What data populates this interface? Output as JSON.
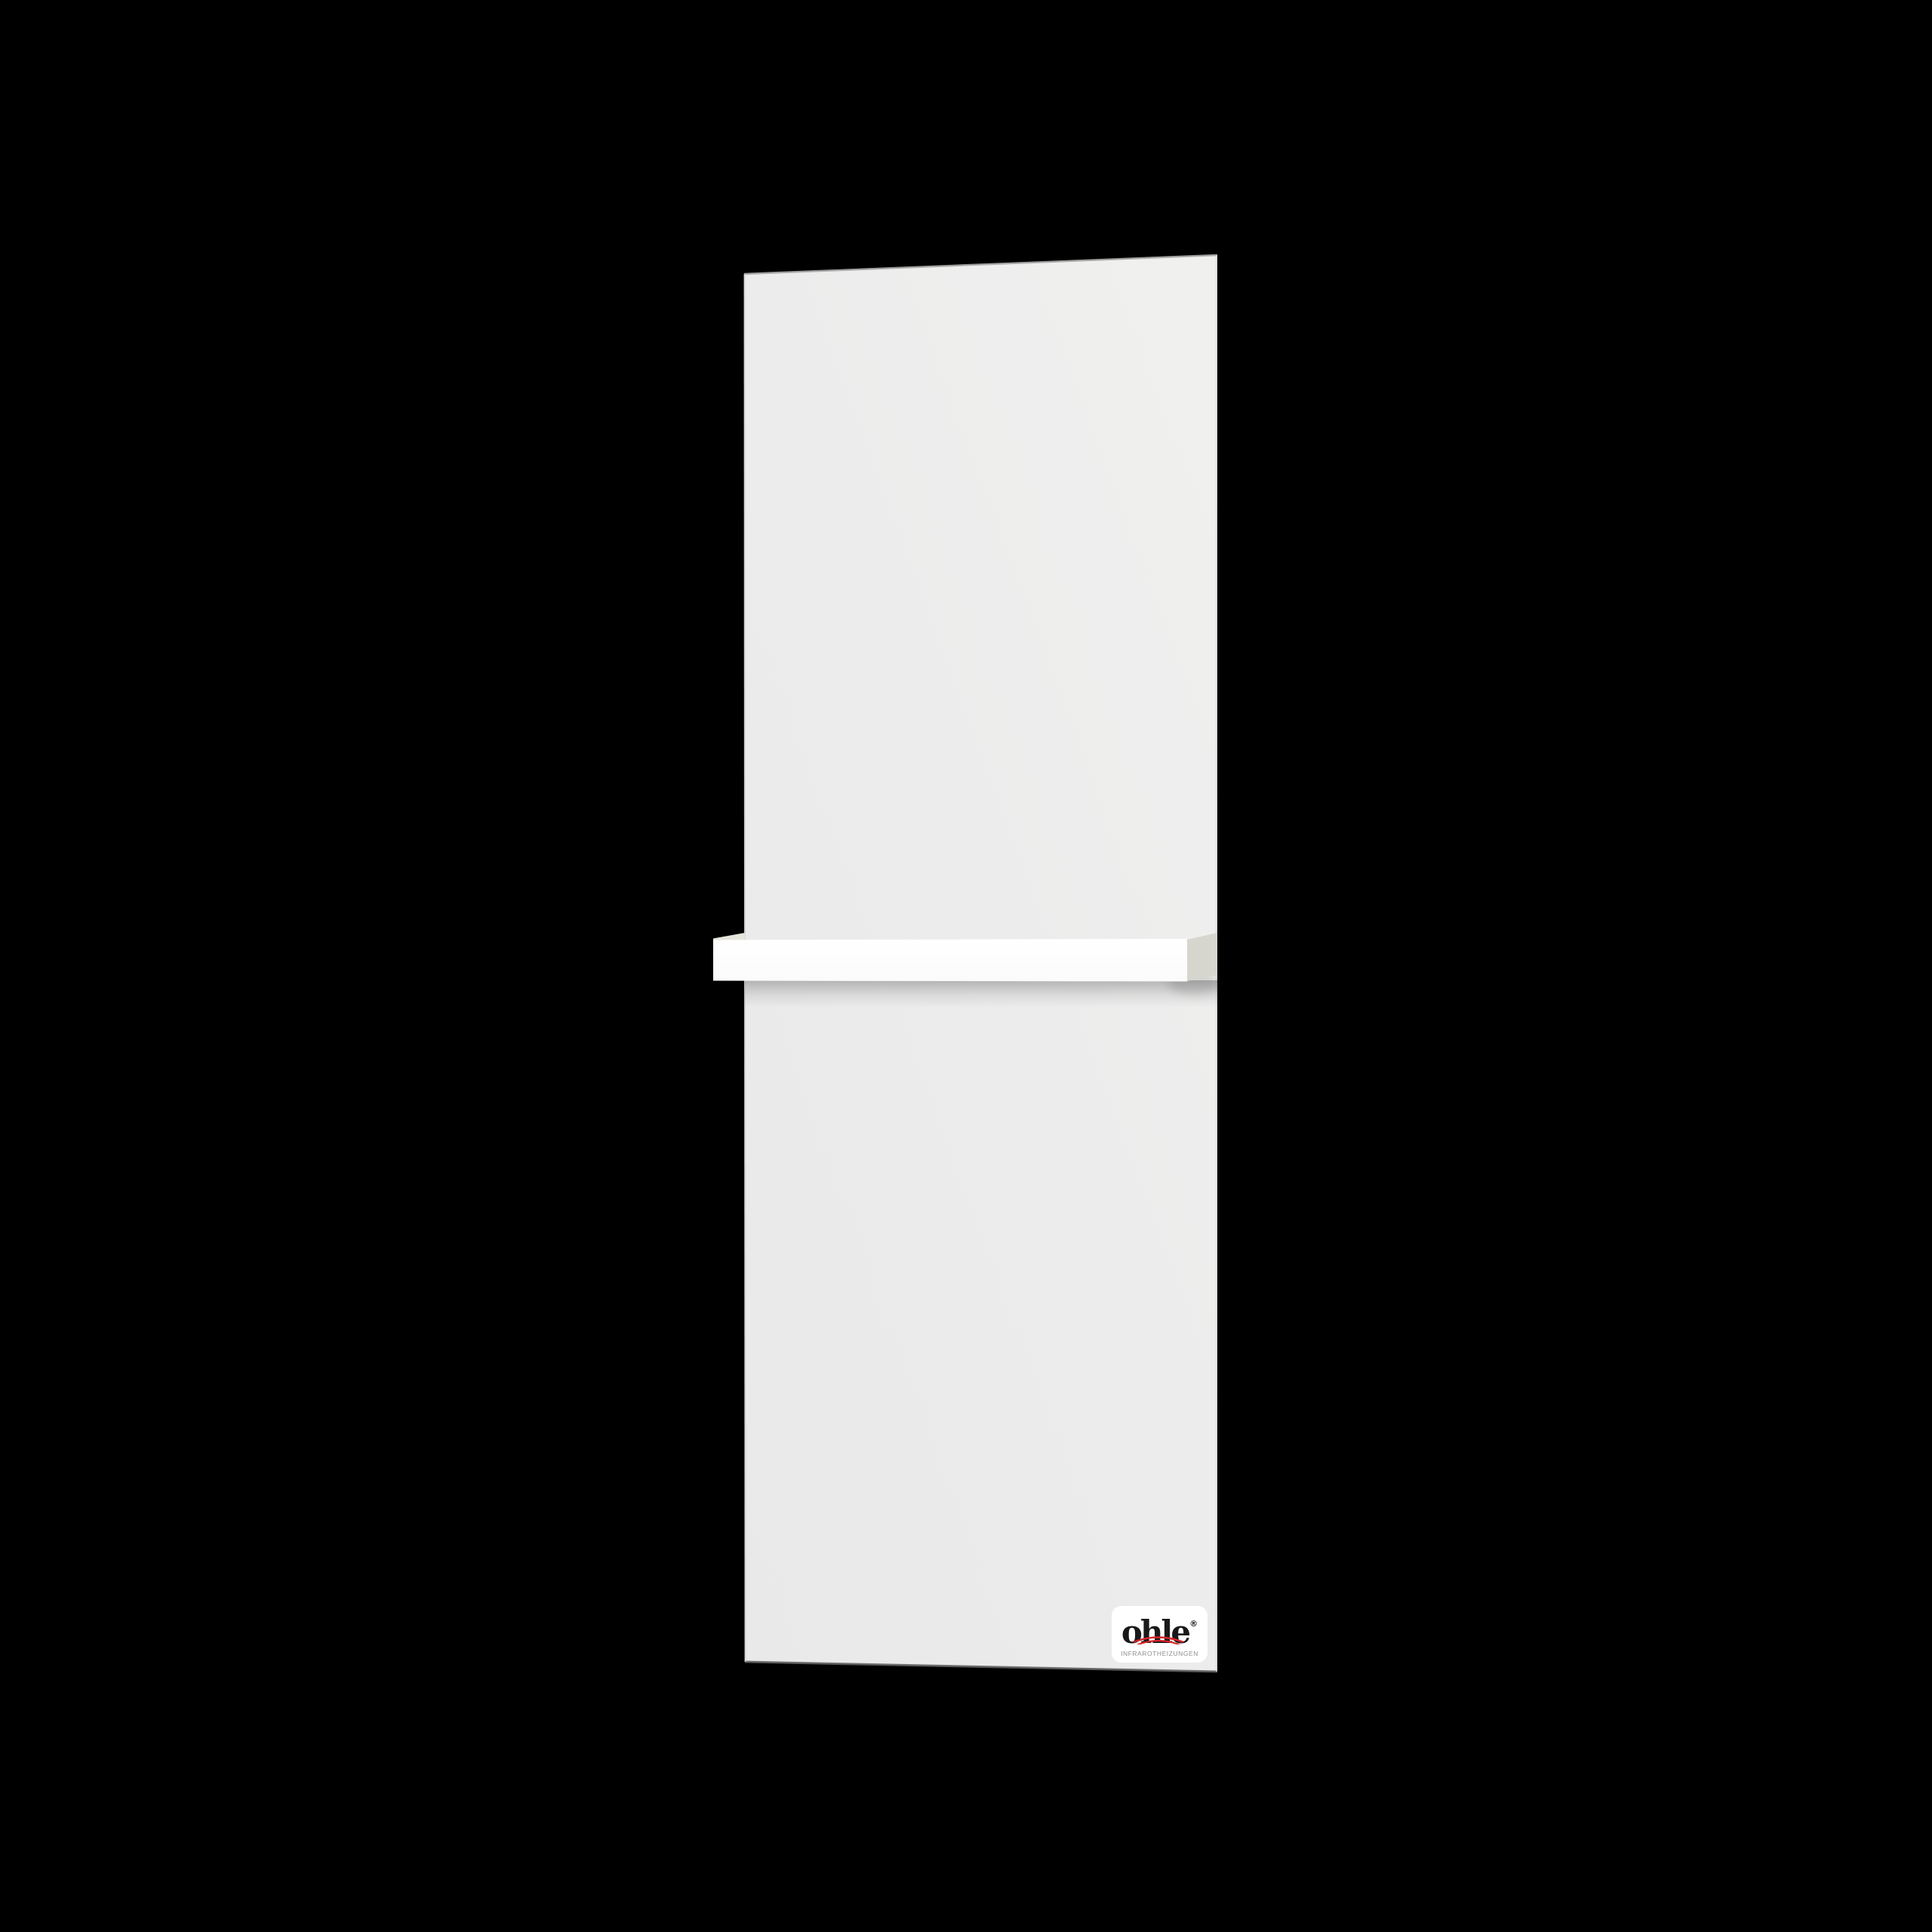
{
  "scene": {
    "description": "Product photo of a vertical infrared heating panel with towel rail on black background",
    "background_color": "#000000",
    "panel": {
      "name": "infrared-heating-panel",
      "color": "#ececec",
      "edge_top_color": "#a9a9a7",
      "edge_bottom_color": "#606060"
    },
    "towel_bar": {
      "name": "towel-rail",
      "front_color": "#fdfdfd",
      "side_color": "#dedeD3",
      "shadow_color": "#3c3c3c"
    },
    "logo": {
      "brand": "ohle",
      "registered_mark": "®",
      "tagline": "INFRAROTHEIZUNGEN",
      "card_color": "#ffffff",
      "brand_color": "#191919",
      "tagline_color": "#8f8f8f",
      "arc_color": "#d8232a"
    }
  }
}
